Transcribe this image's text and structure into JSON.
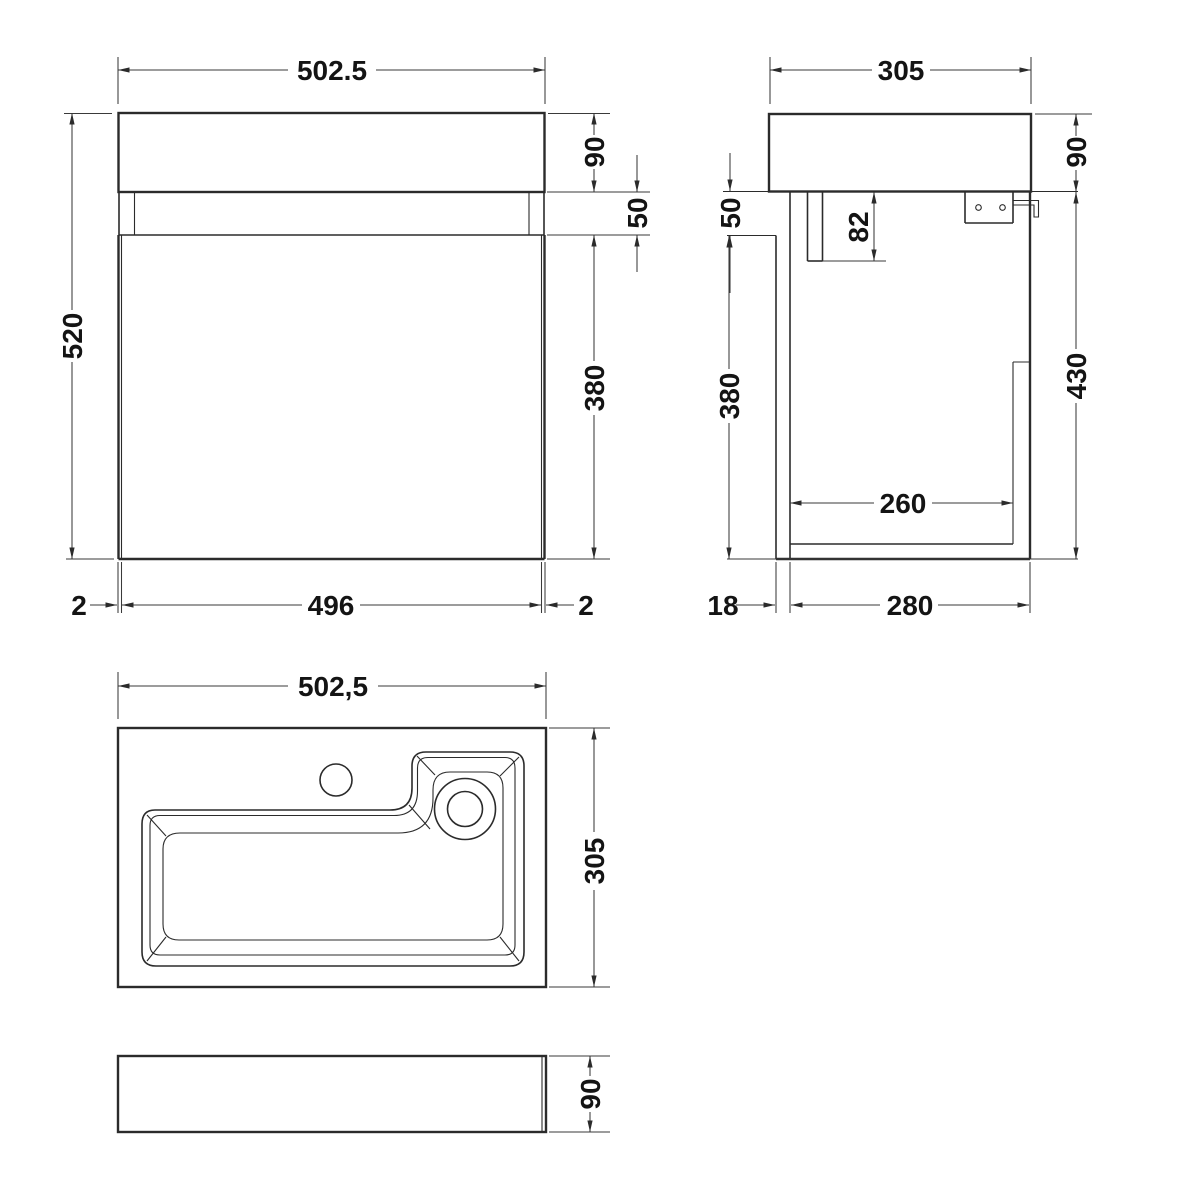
{
  "drawing": {
    "title": "vanity-unit-with-basin-technical-drawing",
    "front": {
      "width": "502.5",
      "height": "520",
      "basin_height": "90",
      "recess_height": "50",
      "door_height": "380",
      "gap_left": "2",
      "door_width": "496",
      "gap_right": "2"
    },
    "side": {
      "depth": "305",
      "basin_height": "90",
      "wall_recess": "50",
      "bracket_drop": "82",
      "internal_height": "380",
      "cabinet_height": "430",
      "internal_depth": "260",
      "back_gap": "18",
      "cabinet_depth": "280"
    },
    "plan": {
      "width": "502,5",
      "depth": "305"
    },
    "profile": {
      "height": "90"
    },
    "line_color": "#2b2b2b",
    "background": "#ffffff"
  }
}
